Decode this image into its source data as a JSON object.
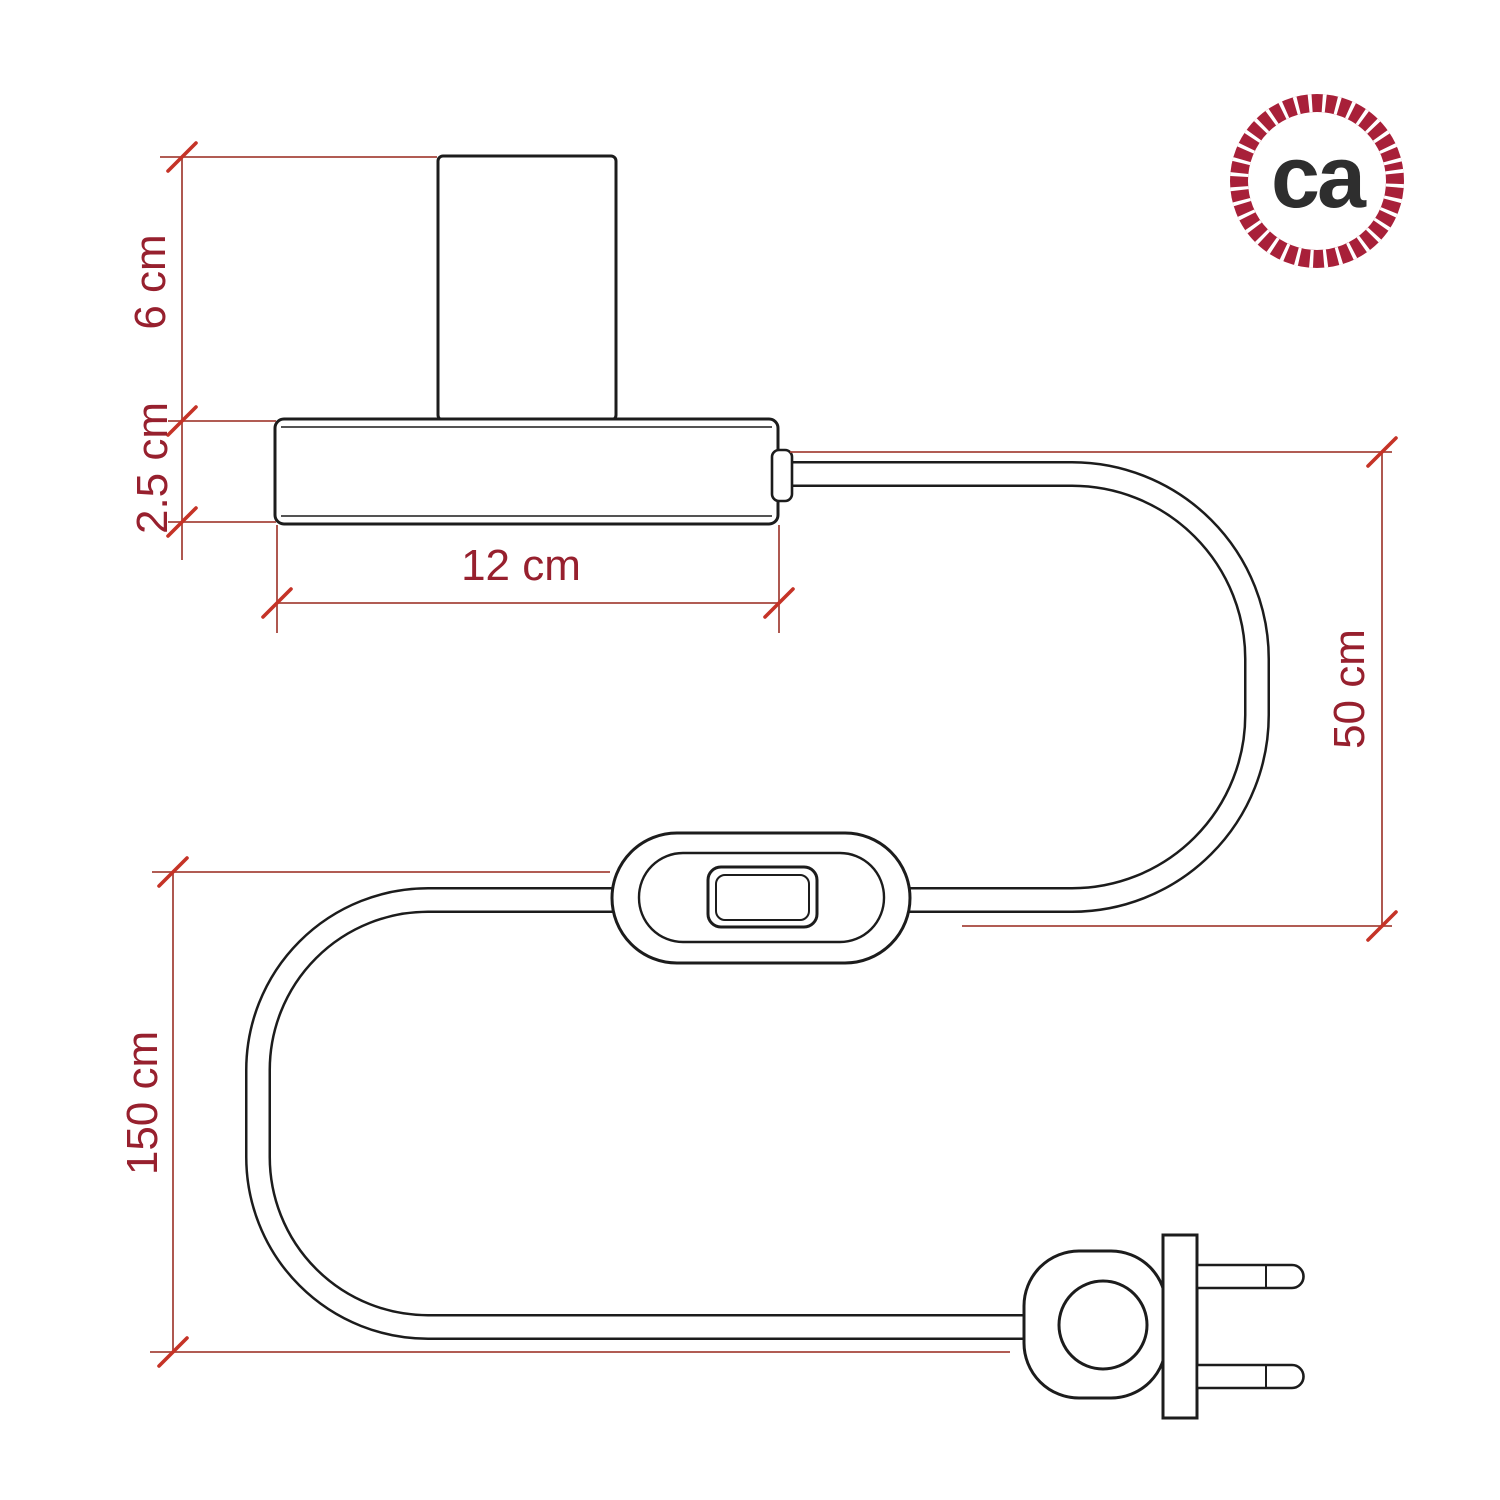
{
  "dimensions": {
    "socket_height": "6 cm",
    "base_thickness": "2.5 cm",
    "base_width": "12 cm",
    "cable_socket_to_switch": "50 cm",
    "cable_switch_to_plug": "150 cm"
  },
  "logo": {
    "text": "ca",
    "icon": "rope-circle-icon"
  },
  "colors": {
    "background": "#ffffff",
    "drawing_line": "#1c1c1c",
    "dimension_line": "#a6453c",
    "dimension_tick": "#c53327",
    "dimension_text": "#97202e",
    "logo_ring": "#a82039",
    "logo_text": "#2e2e2e"
  }
}
